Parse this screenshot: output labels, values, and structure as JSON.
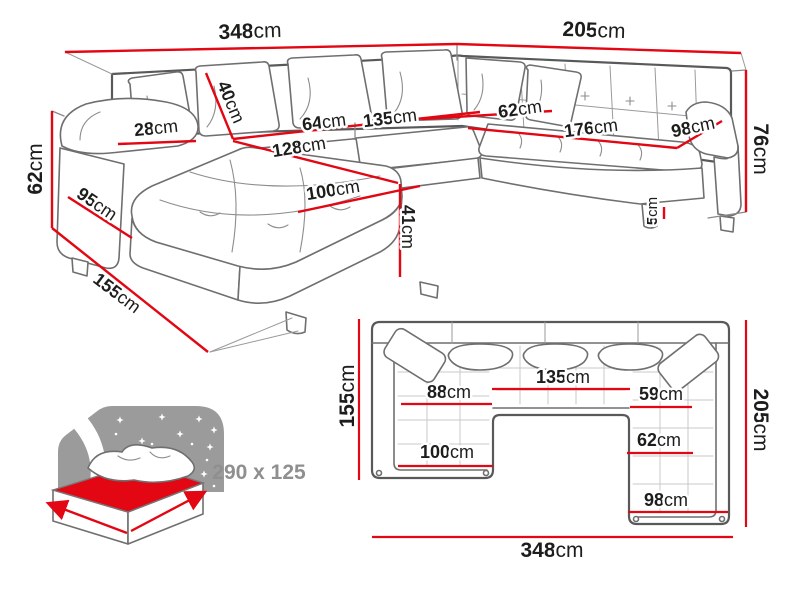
{
  "perspective_view": {
    "measurements": {
      "total_width": {
        "v": "348",
        "u": "cm"
      },
      "right_length": {
        "v": "205",
        "u": "cm"
      },
      "back_height": {
        "v": "76",
        "u": "cm"
      },
      "left_height": {
        "v": "62",
        "u": "cm"
      },
      "armrest_width": {
        "v": "28",
        "u": "cm"
      },
      "side_depth": {
        "v": "95",
        "u": "cm"
      },
      "chaise_depth": {
        "v": "155",
        "u": "cm"
      },
      "cushion_height": {
        "v": "40",
        "u": "cm"
      },
      "seat_64": {
        "v": "64",
        "u": "cm"
      },
      "seat_135": {
        "v": "135",
        "u": "cm"
      },
      "seat_128": {
        "v": "128",
        "u": "cm"
      },
      "chaise_width": {
        "v": "100",
        "u": "cm"
      },
      "seat_height": {
        "v": "41",
        "u": "cm"
      },
      "right_seat_depth": {
        "v": "62",
        "u": "cm"
      },
      "right_seat_length": {
        "v": "176",
        "u": "cm"
      },
      "right_arm_depth": {
        "v": "98",
        "u": "cm"
      },
      "leg_height": {
        "v": "5",
        "u": "cm"
      }
    }
  },
  "plan_view": {
    "measurements": {
      "depth_left": {
        "v": "155",
        "u": "cm"
      },
      "depth_right": {
        "v": "205",
        "u": "cm"
      },
      "total_width": {
        "v": "348",
        "u": "cm"
      },
      "seat_middle": {
        "v": "135",
        "u": "cm"
      },
      "seat_left": {
        "v": "88",
        "u": "cm"
      },
      "seat_right": {
        "v": "59",
        "u": "cm"
      },
      "chaise_width": {
        "v": "100",
        "u": "cm"
      },
      "right_seat": {
        "v": "62",
        "u": "cm"
      },
      "right_total": {
        "v": "98",
        "u": "cm"
      }
    }
  },
  "sleeping_area": {
    "dimensions_label": "290 x 125"
  },
  "colors": {
    "dimension_line": "#e30613",
    "sofa_outline": "#6f6f6f",
    "label_text": "#1d1d1b",
    "muted_text": "#8f8f8f",
    "star_backdrop": "#9b9b9b"
  }
}
